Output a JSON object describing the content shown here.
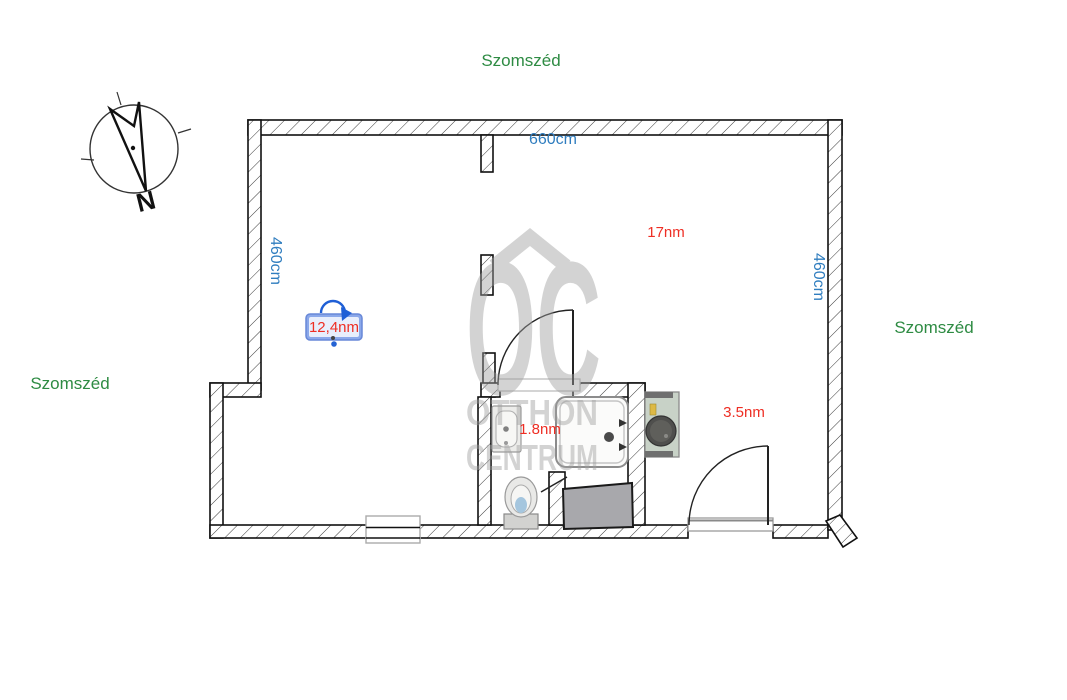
{
  "neighbors": {
    "top": "Szomszéd",
    "left": "Szomszéd",
    "right": "Szomszéd"
  },
  "dimensions": {
    "top_wall": "660cm",
    "left_wall": "460cm",
    "right_wall": "460cm"
  },
  "rooms": {
    "living": {
      "label": "12,4nm",
      "selected": true
    },
    "main": {
      "label": "17nm"
    },
    "bathroom": {
      "label": "1.8nm"
    },
    "hall": {
      "label": "3.5nm"
    }
  },
  "compass": {
    "north_letter": "N"
  },
  "watermark": {
    "monogram": "OC",
    "name_line1": "OTTHON",
    "name_line2": "CENTRUM"
  },
  "colors": {
    "neighbor_green": "#2e8b43",
    "dimension_blue": "#2f7dbf",
    "room_red": "#ee2e24",
    "selection_blue": "#2563d4",
    "selection_box_fill": "#8ba8ea",
    "selection_box_border": "#6888d8",
    "watermark_gray": "#9f9f9f",
    "wall_black": "#111111"
  }
}
